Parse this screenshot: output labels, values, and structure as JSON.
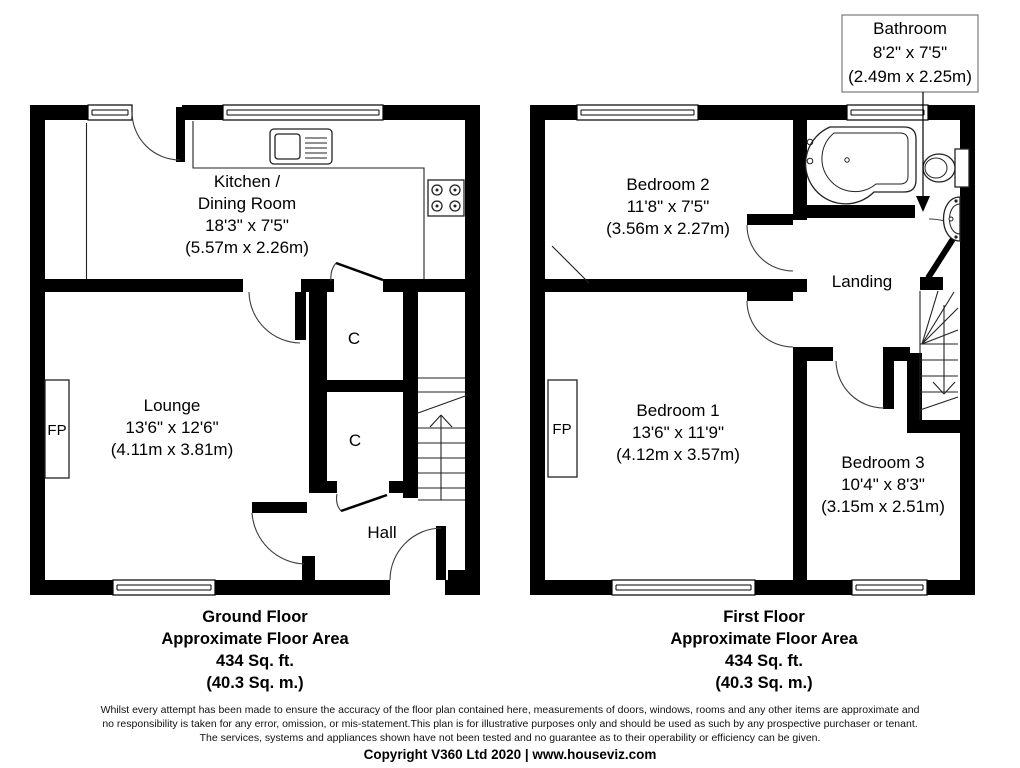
{
  "ground_floor": {
    "rooms": {
      "kitchen": {
        "lines": [
          "Kitchen /",
          "Dining Room",
          "18'3\" x 7'5\"",
          "(5.57m x 2.26m)"
        ]
      },
      "lounge": {
        "lines": [
          "Lounge",
          "13'6\" x 12'6\"",
          "(4.11m x 3.81m)"
        ]
      },
      "hall": {
        "label": "Hall"
      },
      "cupboard_top": {
        "label": "C"
      },
      "cupboard_bottom": {
        "label": "C"
      },
      "fireplace": {
        "label": "FP"
      }
    },
    "area_summary": {
      "lines": [
        "Ground Floor",
        "Approximate Floor Area",
        "434 Sq. ft.",
        "(40.3 Sq. m.)"
      ]
    }
  },
  "first_floor": {
    "rooms": {
      "bedroom_2": {
        "lines": [
          "Bedroom 2",
          "11'8\" x 7'5\"",
          "(3.56m x 2.27m)"
        ]
      },
      "bathroom_callout": {
        "lines": [
          "Bathroom",
          "8'2\" x 7'5\"",
          "(2.49m x 2.25m)"
        ]
      },
      "landing": {
        "label": "Landing"
      },
      "bedroom_1": {
        "lines": [
          "Bedroom 1",
          "13'6\" x 11'9\"",
          "(4.12m x 3.57m)"
        ]
      },
      "bedroom_3": {
        "lines": [
          "Bedroom 3",
          "10'4\" x 8'3\"",
          "(3.15m x 2.51m)"
        ]
      },
      "fireplace": {
        "label": "FP"
      }
    },
    "area_summary": {
      "lines": [
        "First Floor",
        "Approximate Floor Area",
        "434 Sq. ft.",
        "(40.3 Sq. m.)"
      ]
    }
  },
  "footer": {
    "disclaimer_lines": [
      "Whilst every attempt has been made to ensure the accuracy of the floor plan contained here, measurements of doors, windows, rooms and any other items are approximate and",
      "no responsibility is taken for any error, omission, or mis-statement.This plan is for illustrative purposes only and should be used as such by any prospective purchaser or tenant.",
      "The services, systems and appliances shown have not been tested and no guarantee as to their operability or efficiency can be given."
    ],
    "copyright": "Copyright V360 Ltd 2020 | www.houseviz.com"
  },
  "colors": {
    "wall": "#000000",
    "line": "#2a2a2a",
    "text": "#000000",
    "callout_border": "#7a7a7a",
    "background": "#ffffff"
  }
}
